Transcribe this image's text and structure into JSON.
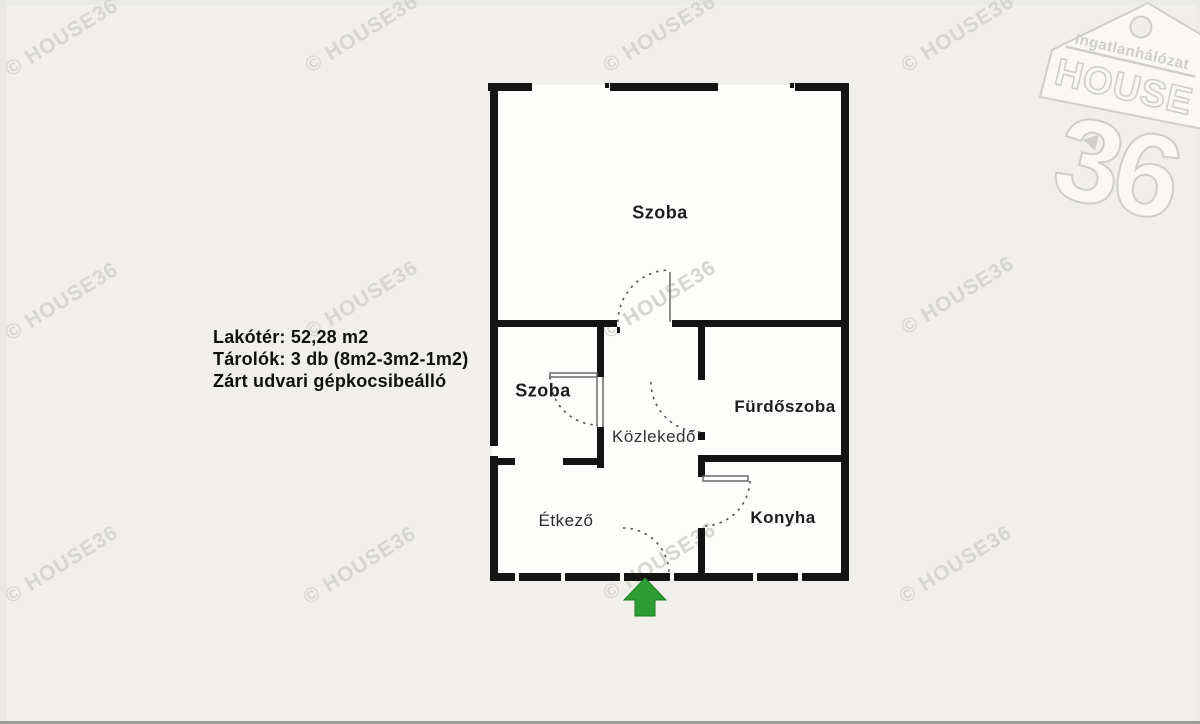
{
  "watermark": {
    "text": "© HOUSE36"
  },
  "logo": {
    "network_label": "Ingatlanhálózat",
    "brand": "HOUSE",
    "number": "36"
  },
  "info": {
    "line1": "Lakótér: 52,28 m2",
    "line2": "Tárolók: 3 db (8m2-3m2-1m2)",
    "line3": "Zárt udvari gépkocsibeálló"
  },
  "rooms": {
    "living_room": "Szoba",
    "bedroom": "Szoba",
    "bathroom": "Fürdőszoba",
    "hallway": "Közlekedő",
    "dining": "Étkező",
    "kitchen": "Konyha"
  },
  "colors": {
    "background": "#f0efeb",
    "wall_black": "#141414",
    "watermark_gray": "#d6d5d0",
    "entrance_arrow_green": "#2d9c33",
    "logo_gray": "#cfcecb"
  }
}
